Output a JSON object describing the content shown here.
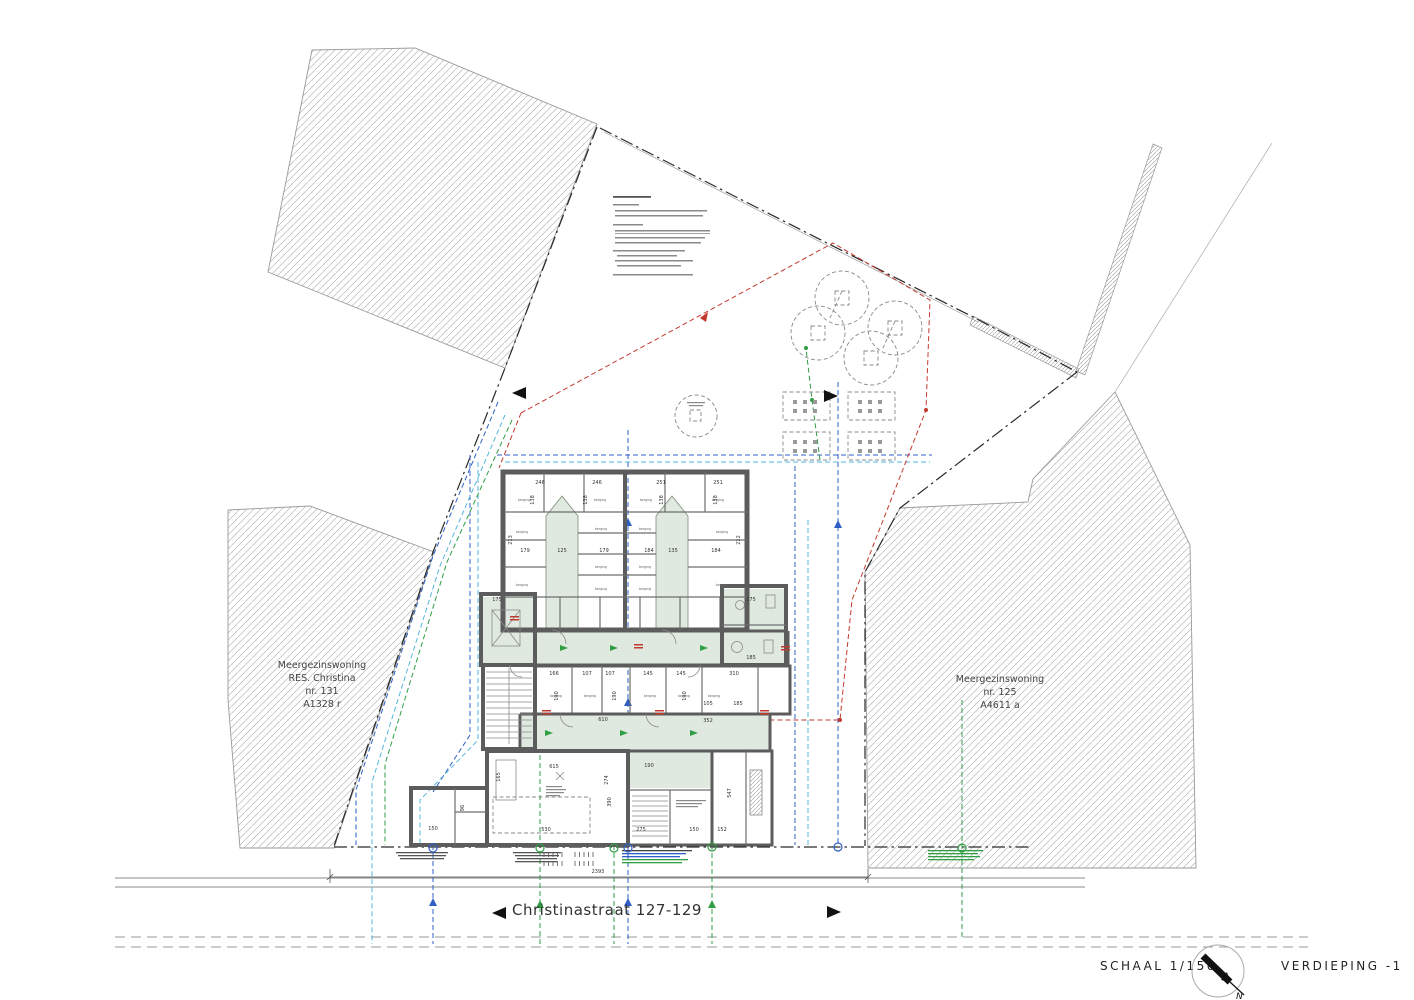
{
  "title_block": {
    "scale_label": "SCHAAL 1/150",
    "level_label": "VERDIEPING -1",
    "north_letter": "N"
  },
  "street": {
    "name": "Christinastraat 127-129",
    "overall_dimension": "2393"
  },
  "parcels": {
    "left": {
      "lines": [
        "Meergezinswoning",
        "RES. Christina",
        "nr. 131",
        "A1328 r"
      ]
    },
    "right": {
      "lines": [
        "Meergezinswoning",
        "nr. 125",
        "A4611 a"
      ]
    }
  },
  "plan": {
    "room_label": "berging",
    "dims": [
      {
        "t": "246",
        "x": 540,
        "y": 484
      },
      {
        "t": "246",
        "x": 597,
        "y": 484
      },
      {
        "t": "251",
        "x": 661,
        "y": 484
      },
      {
        "t": "251",
        "x": 718,
        "y": 484
      },
      {
        "t": "138",
        "x": 534,
        "y": 500,
        "r": -90
      },
      {
        "t": "138",
        "x": 587,
        "y": 500,
        "r": -90
      },
      {
        "t": "138",
        "x": 663,
        "y": 500,
        "r": -90
      },
      {
        "t": "138",
        "x": 717,
        "y": 500,
        "r": -90
      },
      {
        "t": "213",
        "x": 512,
        "y": 540,
        "r": -90
      },
      {
        "t": "212",
        "x": 740,
        "y": 540,
        "r": -90
      },
      {
        "t": "179",
        "x": 525,
        "y": 552
      },
      {
        "t": "125",
        "x": 562,
        "y": 552
      },
      {
        "t": "179",
        "x": 604,
        "y": 552
      },
      {
        "t": "184",
        "x": 649,
        "y": 552
      },
      {
        "t": "135",
        "x": 673,
        "y": 552
      },
      {
        "t": "184",
        "x": 716,
        "y": 552
      },
      {
        "t": "175",
        "x": 497,
        "y": 601
      },
      {
        "t": "175",
        "x": 751,
        "y": 601
      },
      {
        "t": "185",
        "x": 751,
        "y": 659
      },
      {
        "t": "166",
        "x": 554,
        "y": 675
      },
      {
        "t": "107",
        "x": 587,
        "y": 675
      },
      {
        "t": "107",
        "x": 610,
        "y": 675
      },
      {
        "t": "145",
        "x": 648,
        "y": 675
      },
      {
        "t": "145",
        "x": 681,
        "y": 675
      },
      {
        "t": "310",
        "x": 734,
        "y": 675
      },
      {
        "t": "190",
        "x": 558,
        "y": 696,
        "r": -90
      },
      {
        "t": "190",
        "x": 616,
        "y": 696,
        "r": -90
      },
      {
        "t": "190",
        "x": 686,
        "y": 696,
        "r": -90
      },
      {
        "t": "105",
        "x": 708,
        "y": 705
      },
      {
        "t": "185",
        "x": 738,
        "y": 705
      },
      {
        "t": "610",
        "x": 603,
        "y": 721
      },
      {
        "t": "352",
        "x": 708,
        "y": 722
      },
      {
        "t": "615",
        "x": 554,
        "y": 768
      },
      {
        "t": "190",
        "x": 649,
        "y": 767
      },
      {
        "t": "274",
        "x": 608,
        "y": 780,
        "r": -90
      },
      {
        "t": "390",
        "x": 611,
        "y": 802,
        "r": -90
      },
      {
        "t": "165",
        "x": 500,
        "y": 777,
        "r": -90
      },
      {
        "t": "96",
        "x": 464,
        "y": 808,
        "r": -90
      },
      {
        "t": "547",
        "x": 731,
        "y": 793,
        "r": -90
      },
      {
        "t": "530",
        "x": 546,
        "y": 831
      },
      {
        "t": "275",
        "x": 641,
        "y": 831
      },
      {
        "t": "150",
        "x": 694,
        "y": 831
      },
      {
        "t": "152",
        "x": 722,
        "y": 831
      },
      {
        "t": "150",
        "x": 433,
        "y": 830
      }
    ],
    "room_positions": [
      [
        524,
        501
      ],
      [
        600,
        501
      ],
      [
        646,
        501
      ],
      [
        718,
        501
      ],
      [
        522,
        533
      ],
      [
        722,
        533
      ],
      [
        601,
        530
      ],
      [
        645,
        530
      ],
      [
        601,
        568
      ],
      [
        645,
        568
      ],
      [
        522,
        586
      ],
      [
        722,
        586
      ],
      [
        601,
        590
      ],
      [
        645,
        590
      ],
      [
        556,
        697
      ],
      [
        590,
        697
      ],
      [
        650,
        697
      ],
      [
        684,
        697
      ],
      [
        714,
        697
      ]
    ]
  },
  "colors": {
    "wall": "#5c5c5c",
    "sage": "#dfe9df",
    "hatch": "#b8b8b8",
    "blue": "#2f5fc4",
    "cyan": "#56b6dc",
    "green": "#2f9e44",
    "red": "#c23a2f"
  }
}
